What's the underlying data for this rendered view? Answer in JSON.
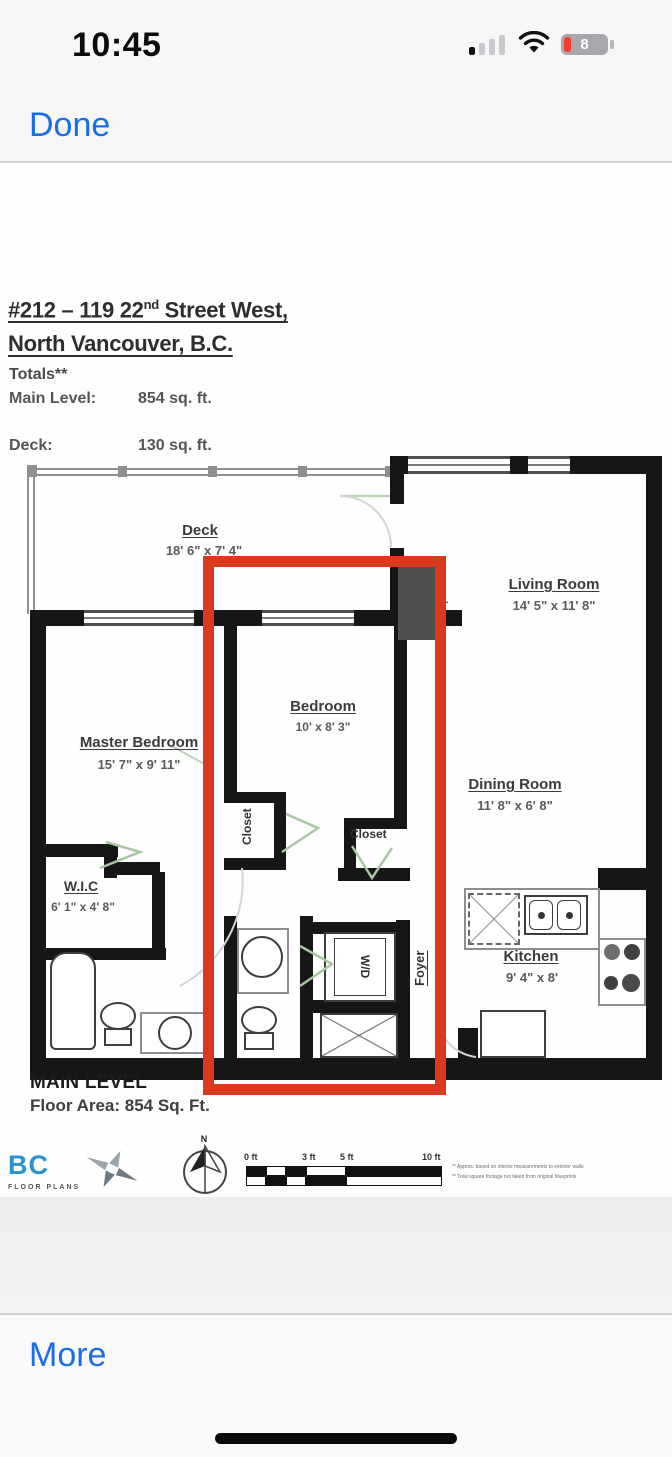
{
  "status_bar": {
    "time": "10:45",
    "battery_percent": "8"
  },
  "nav": {
    "done_label": "Done"
  },
  "toolbar": {
    "more_label": "More"
  },
  "colors": {
    "ios_blue": "#1c6ce8",
    "highlight_red": "#d93a1e",
    "battery_red": "#fb3b2f",
    "wall_black": "#161616",
    "fireplace_gray": "#4f4f4f",
    "logo_blue": "#2a93cf"
  },
  "plan": {
    "title": {
      "line1_pre": "#212 – 119 22",
      "line1_sup": "nd",
      "line1_post": " Street West,",
      "line2": "North Vancouver, B.C."
    },
    "totals": {
      "heading": "Totals**",
      "main_level_label": "Main Level:",
      "main_level_value": "854 sq. ft.",
      "deck_label": "Deck:",
      "deck_value": "130 sq. ft."
    },
    "rooms": {
      "deck": {
        "name": "Deck",
        "dims": "18' 6\" x 7' 4\""
      },
      "living": {
        "name": "Living Room",
        "dims": "14' 5\" x 11' 8\""
      },
      "bedroom": {
        "name": "Bedroom",
        "dims": "10' x 8' 3\""
      },
      "master": {
        "name": "Master Bedroom",
        "dims": "15' 7\" x 9' 11\""
      },
      "dining": {
        "name": "Dining Room",
        "dims": "11' 8\" x 6' 8\""
      },
      "wic": {
        "name": "W.I.C",
        "dims": "6' 1\" x 4' 8\""
      },
      "kitchen": {
        "name": "Kitchen",
        "dims": "9' 4\" x 8'"
      },
      "foyer": {
        "name": "Foyer",
        "dims": "6' 9\" x 4' 1\""
      },
      "closet1": {
        "name": "Closet"
      },
      "closet2": {
        "name": "Closet"
      },
      "fireplace": {
        "name": "Fireplace"
      },
      "washer_dryer": {
        "name": "W/D"
      }
    },
    "footer": {
      "level_title": "MAIN LEVEL",
      "floor_area": "Floor Area: 854 Sq. Ft."
    },
    "logo": {
      "bc": "BC",
      "sub": "FLOOR PLANS"
    },
    "compass": {
      "north": "N"
    },
    "scale": {
      "ticks": {
        "0": "0 ft",
        "1": "3 ft",
        "2": "5 ft",
        "3": "10 ft"
      }
    },
    "disclaimer": {
      "line1": "** Approx. based on interior measurements to exterior walls",
      "line2": "** Total square footage not taken from original blueprints"
    }
  }
}
